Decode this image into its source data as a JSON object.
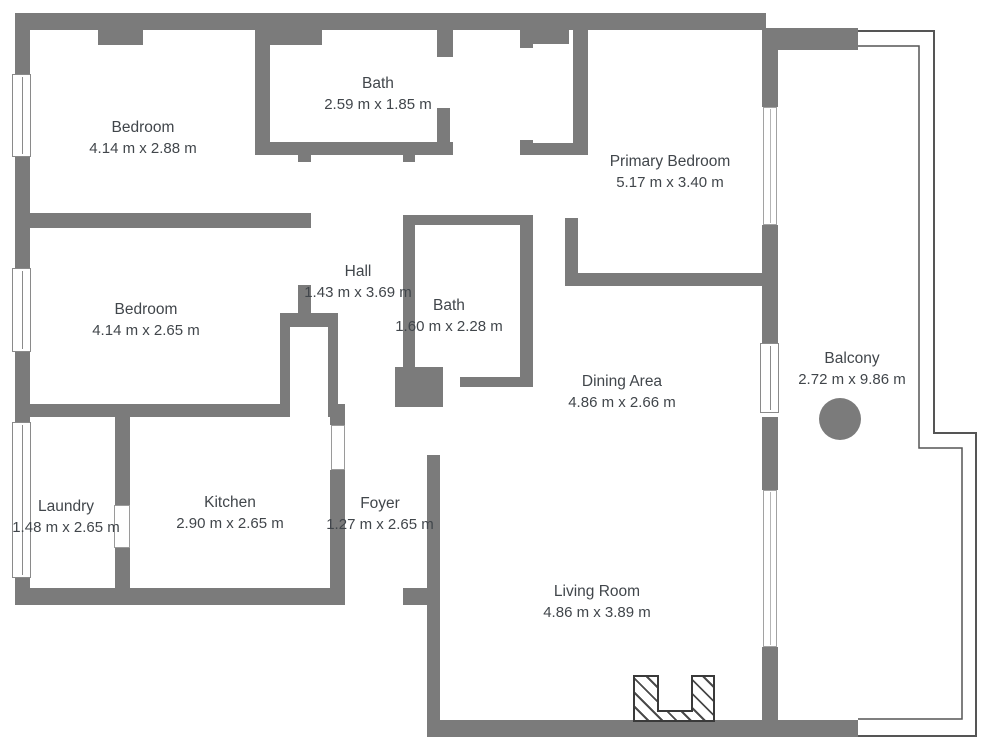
{
  "plan": {
    "type": "apartment-floor-plan",
    "wall_color": "#7b7b7b",
    "text_color": "#41464b",
    "rooms": [
      {
        "name": "Bedroom",
        "dims": "4.14 m x 2.88 m"
      },
      {
        "name": "Bath",
        "dims": "2.59 m x 1.85 m"
      },
      {
        "name": "Primary Bedroom",
        "dims": "5.17 m x 3.40 m"
      },
      {
        "name": "Bedroom",
        "dims": "4.14 m x 2.65 m"
      },
      {
        "name": "Hall",
        "dims": "1.43 m x 3.69 m"
      },
      {
        "name": "Bath",
        "dims": "1.60 m x 2.28 m"
      },
      {
        "name": "Dining Area",
        "dims": "4.86 m x 2.66 m"
      },
      {
        "name": "Balcony",
        "dims": "2.72 m x 9.86 m"
      },
      {
        "name": "Laundry",
        "dims": "1.48 m x 2.65 m"
      },
      {
        "name": "Kitchen",
        "dims": "2.90 m x 2.65 m"
      },
      {
        "name": "Foyer",
        "dims": "1.27 m x 2.65 m"
      },
      {
        "name": "Living Room",
        "dims": "4.86 m x 3.89 m"
      }
    ]
  }
}
